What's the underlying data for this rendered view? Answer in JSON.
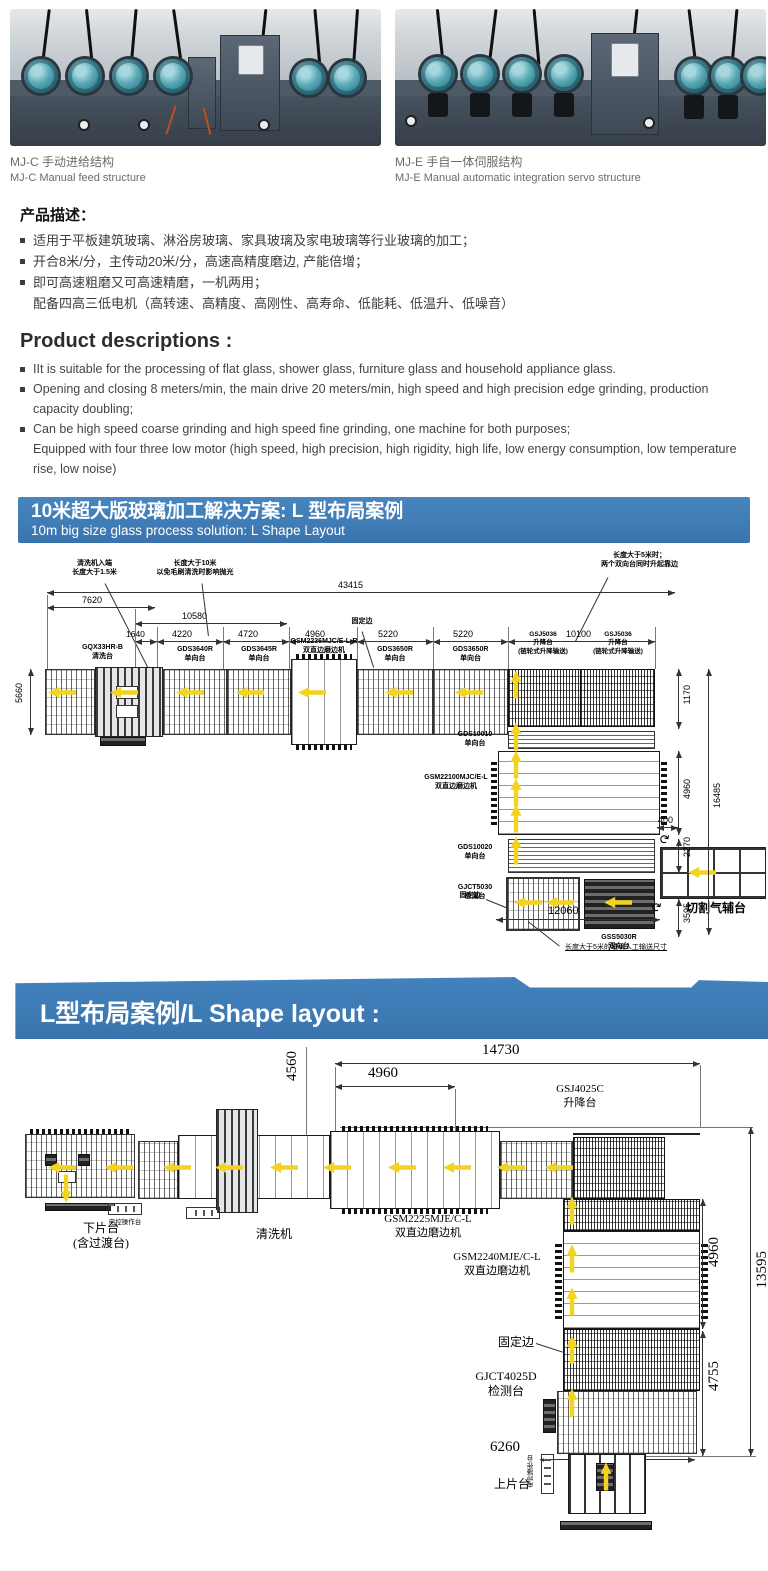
{
  "accent_blue": "#3d7ab8",
  "arrow_yellow": "#f2d31f",
  "photo_teal": "#4fa3b3",
  "photos": {
    "left": {
      "caption_zh": "MJ-C 手动进给结构",
      "caption_en": "MJ-C Manual feed structure"
    },
    "right": {
      "caption_zh": "MJ-E 手自一体伺服结构",
      "caption_en": "MJ-E Manual automatic  integration servo structure"
    }
  },
  "desc_zh": {
    "title": "产品描述：",
    "bullets": [
      "适用于平板建筑玻璃、淋浴房玻璃、家具玻璃及家电玻璃等行业玻璃的加工；",
      "开合8米/分，主传动20米/分，高速高精度磨边, 产能倍增；",
      "即可高速粗磨又可高速精磨，一机两用；"
    ],
    "continuation": "配备四高三低电机（高转速、高精度、高刚性、高寿命、低能耗、低温升、低噪音）"
  },
  "desc_en": {
    "title": "Product descriptions :",
    "bullets": [
      "IIt is suitable for the processing of flat glass, shower glass, furniture glass and household appliance glass.",
      "Opening and closing 8 meters/min, the main drive 20 meters/min, high speed and high precision edge grinding, production capacity doubling;",
      "Can be high speed coarse grinding and high speed fine grinding, one machine for both purposes;"
    ],
    "continuation": "Equipped with four three low motor (high speed, high precision, high rigidity, high life, low energy consumption, low temperature rise, low noise)"
  },
  "banner1": {
    "title_zh": "10米超大版玻璃加工解决方案: L 型布局案例",
    "title_en": "10m big size glass process solution: L Shape Layout"
  },
  "banner2": {
    "title": "L型布局案例/L Shape layout :"
  },
  "d1": {
    "dims": {
      "total": "43415",
      "a": "7620",
      "b": "10580",
      "row": [
        "1640",
        "4220",
        "4720",
        "4960",
        "5220",
        "5220",
        "10100"
      ],
      "left": "5660",
      "r1170": "1170",
      "r4960": "4960",
      "r2270": "2270",
      "r400": "400",
      "r3595": "3595",
      "r16485": "16485",
      "b12060": "12060"
    },
    "machines": [
      "GQX33HR-B\n清洗台",
      "GDS3640R\n单向台",
      "GDS3645R\n单向台",
      "GSM2236MJC/E-L-R\n双直边磨边机",
      "GDS3650R\n单向台",
      "GDS3650R\n单向台",
      "GSJ5036\n升降台\n(链轮式升降输送)",
      "GSJ5036\n升降台\n(链轮式升降输送)",
      "GDS10010\n单向台",
      "GSM22100MJC/E-L\n双直边磨边机",
      "GDS10020\n单向台",
      "GJCT5030\n检测台",
      "GSS5030R\n双向台",
      "切割气辅台"
    ],
    "fixed_edge": "固定边",
    "ann": [
      "清洗机入端\n长度大于1.5米",
      "长度大于10米\n以免毛刷清洗时影响抛光",
      "长度大于5米时；\n两个双向台同时升起靠边",
      "长度大于5米的玻璃人工输送尺寸"
    ]
  },
  "d2": {
    "dims": {
      "t14730": "14730",
      "t4960": "4960",
      "t4560": "4560",
      "r4960": "4960",
      "r13595": "13595",
      "r4755": "4755",
      "b6260": "6260"
    },
    "labels": [
      "下片台\n(含过渡台)",
      "电控操作台",
      "清洗机",
      "GSM2225MJE/C-L\n双直边磨边机",
      "GSJ4025C\n升降台",
      "GSM2240MJE/C-L\n双直边磨边机",
      "固定边",
      "GJCT4025D\n检测台",
      "上片台",
      "电控操作台"
    ]
  }
}
